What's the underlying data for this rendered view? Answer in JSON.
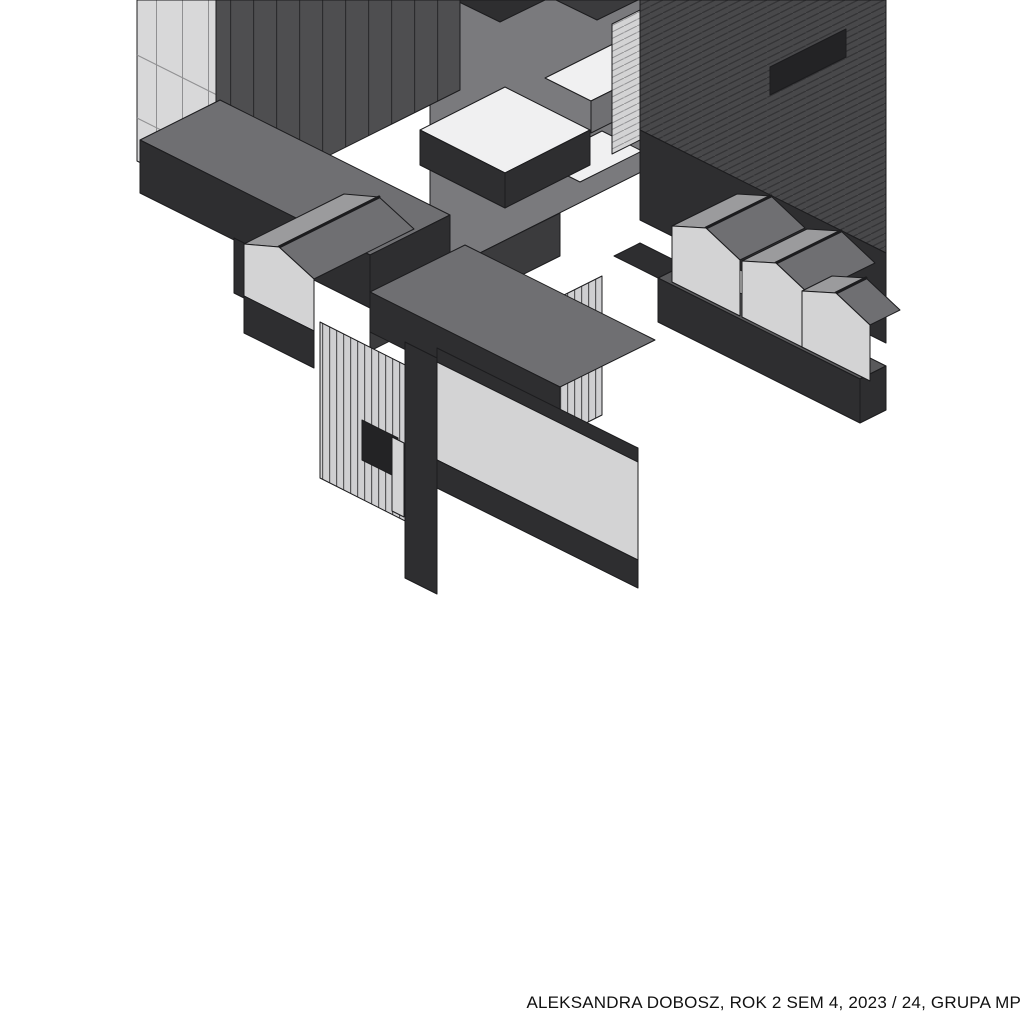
{
  "caption": {
    "text": "ALEKSANDRA DOBOSZ, ROK 2 SEM 4, 2023 / 24, GRUPA MP"
  },
  "drawing": {
    "kind": "cutaway axonometric architectural drawing",
    "hatches": [
      "diagonal-seam-roof",
      "vertical-slat-wall",
      "panel-grid-facade",
      "vertical-line-roof"
    ]
  },
  "colors": {
    "paper": "#ffffff",
    "ink": "#1c1c1e",
    "inkdark": "#232325",
    "darkwall": "#2e2e30",
    "darkwall2": "#3b3b3d",
    "darkroof": "#48484a",
    "hatchline": "#343436",
    "floorgray": "#59595b",
    "midroof": "#6f6f72",
    "midwall": "#7a7a7d",
    "slope": "#9b9b9d",
    "lightwall": "#d3d3d4",
    "facadelight": "#d8d8d9",
    "facadeline": "#909092",
    "slatbg": "#cfcfd1",
    "slatline": "#58585a",
    "vertroofbg": "#4e4e50",
    "roofline": "#2c2c2e",
    "floorwhite": "#f0f0f1",
    "captiontext": "#111111"
  }
}
